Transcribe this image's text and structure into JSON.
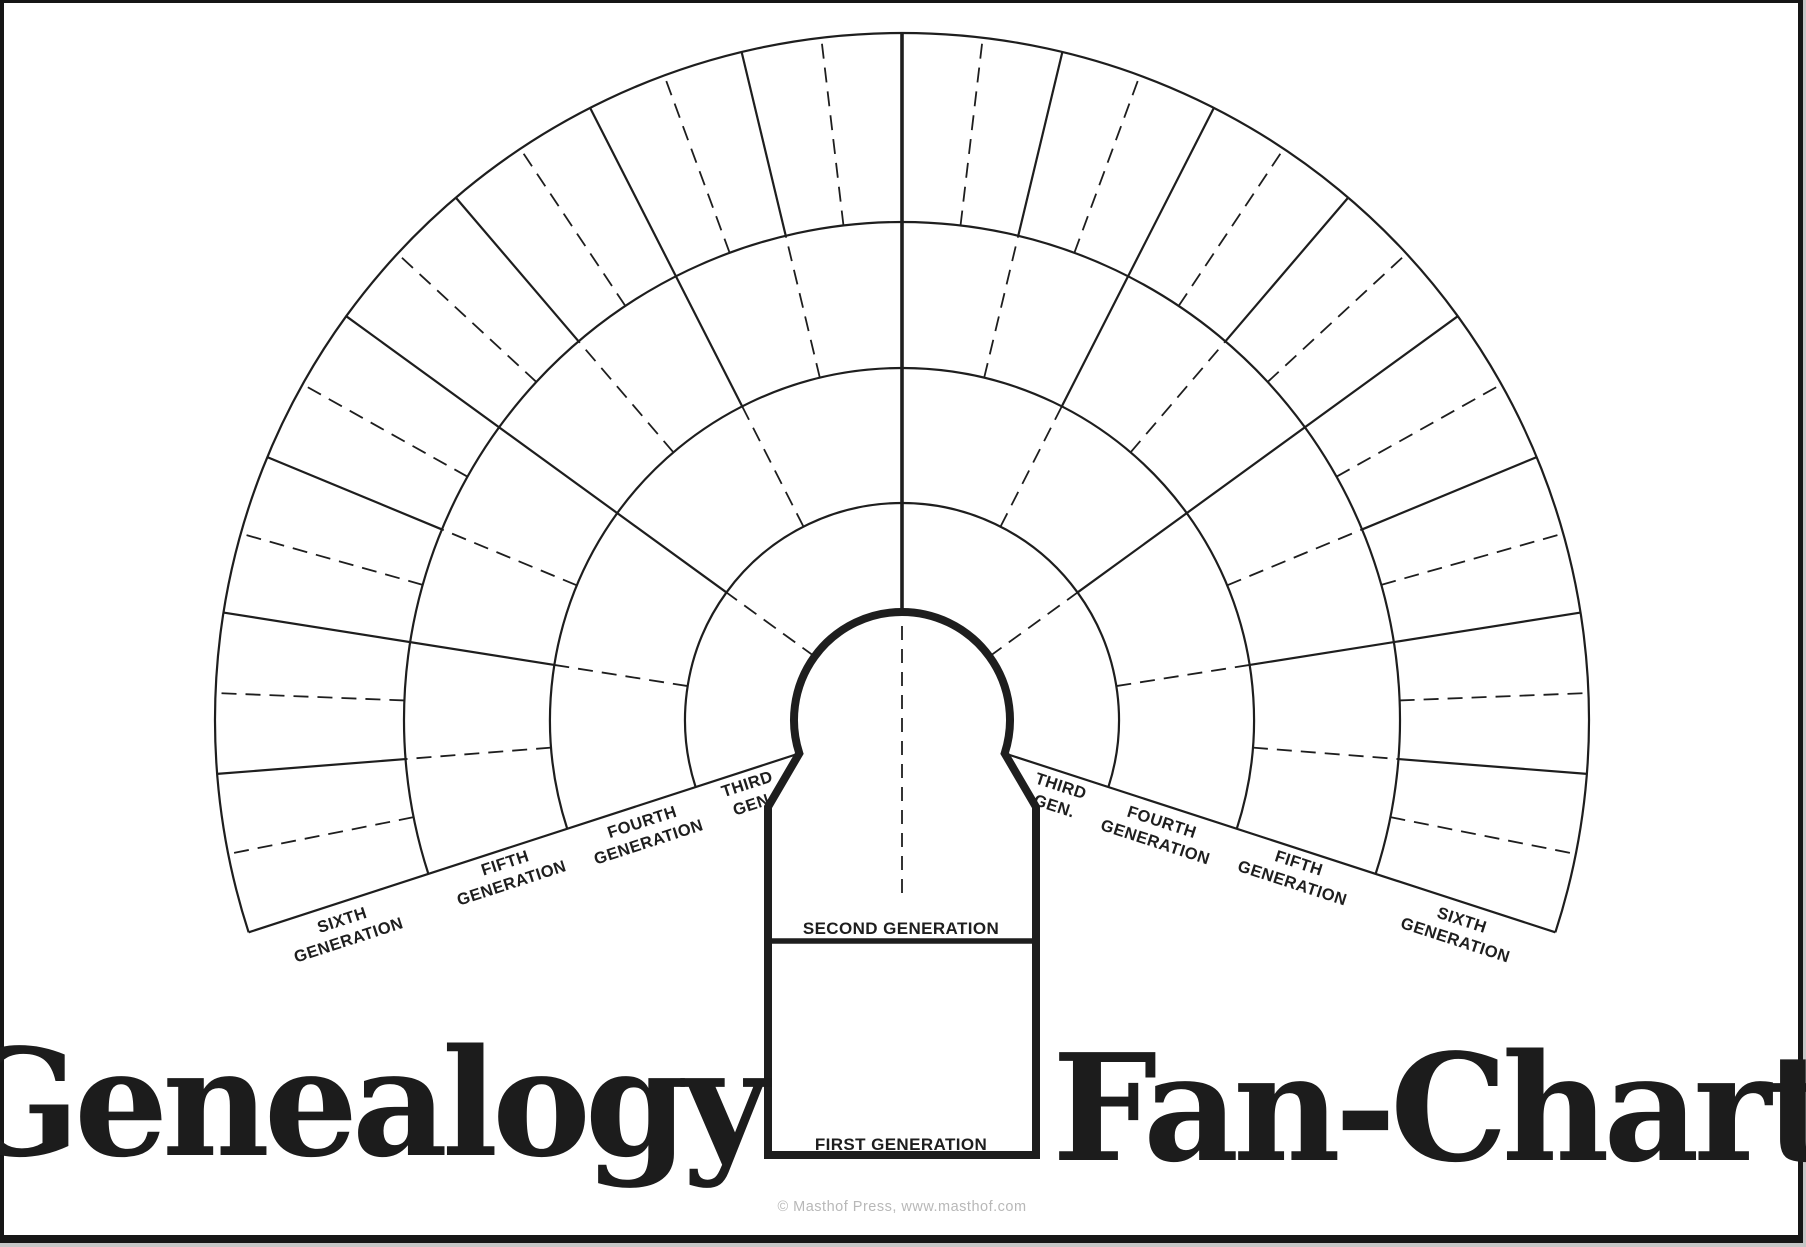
{
  "page": {
    "background": "#ffffff",
    "frame_color": "#161616",
    "line_color": "#1e1e1e",
    "muted_text_color": "#b8b8b8"
  },
  "titles": {
    "left": "Genealogy",
    "right": "Fan-Chart"
  },
  "keyhole": {
    "second_generation_label": "SECOND GENERATION",
    "first_generation_label": "FIRST GENERATION"
  },
  "footer": {
    "copyright": "© Masthof Press, www.masthof.com"
  },
  "fan": {
    "center_x": 902,
    "center_y": 720,
    "ring_radii": [
      108,
      217,
      352,
      498,
      687
    ],
    "start_angle_deg": -18,
    "span_deg": 216,
    "ray_steps": 32,
    "solid_width": 2.2,
    "center_ray_width": 3.6,
    "dashed_width": 1.8,
    "arc_width": 2.2,
    "keyhole_outline_width": 8,
    "divider_width": 5.5,
    "keyhole": {
      "wall_left_x": 768,
      "wall_right_x": 1036,
      "shoulder_y": 807,
      "bottom_y": 1155,
      "divider_y": 941
    },
    "center_dash_top_y": 626,
    "center_dash_bottom_y": 896,
    "generation_rings": [
      {
        "generation": 3,
        "label_lines": [
          "THIRD",
          "GEN."
        ],
        "person_cells": 4
      },
      {
        "generation": 4,
        "label_lines": [
          "FOURTH",
          "GENERATION"
        ],
        "person_cells": 8
      },
      {
        "generation": 5,
        "label_lines": [
          "FIFTH",
          "GENERATION"
        ],
        "person_cells": 16
      },
      {
        "generation": 6,
        "label_lines": [
          "SIXTH",
          "GENERATION"
        ],
        "person_cells": 32
      }
    ]
  }
}
